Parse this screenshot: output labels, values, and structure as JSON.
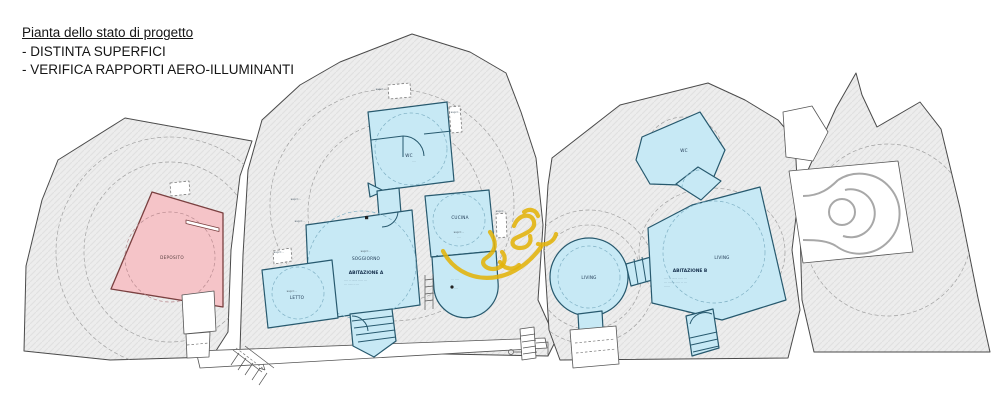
{
  "title": {
    "heading": "Pianta dello stato di progetto",
    "bullet1": "- DISTINTA SUPERFICI",
    "bullet2": "- VERIFICA RAPPORTI AERO-ILLUMINANTI"
  },
  "palette": {
    "unit_fill": "#c7e9f5",
    "unit_border": "#27596e",
    "deposito_fill": "#f5c4c8",
    "deposito_border": "#7a4040",
    "rock_fill": "#ededed",
    "rock_outline": "#4a4a4a",
    "marker_yellow": "#e3b30a"
  },
  "rooms": {
    "deposito": "DEPOSITO",
    "wc_a": "WC",
    "cucina": "CUCINA",
    "soggiorno": "SOGGIORNO",
    "abitazione_a": "ABITAZIONE A",
    "letto": "LETTO",
    "living_circle": "LIVING",
    "living_b": "LIVING",
    "abitazione_b": "ABITAZIONE B",
    "wc_b": "WC"
  },
  "annotations": {
    "items": [
      {
        "x": 381,
        "y": 90,
        "text": "sup=···"
      },
      {
        "x": 456,
        "y": 113,
        "text": "sup=···"
      },
      {
        "x": 296,
        "y": 200,
        "text": "sup=···"
      },
      {
        "x": 300,
        "y": 222,
        "text": "sup=···"
      },
      {
        "x": 279,
        "y": 253,
        "text": "sup=···"
      },
      {
        "x": 366,
        "y": 252,
        "text": "sup=···"
      },
      {
        "x": 292,
        "y": 292,
        "text": "sup=···"
      },
      {
        "x": 459,
        "y": 233,
        "text": "sup=···"
      },
      {
        "x": 459,
        "y": 238,
        "text": "····"
      },
      {
        "x": 501,
        "y": 212,
        "text": "sup=···"
      },
      {
        "x": 414,
        "y": 162,
        "text": "····"
      },
      {
        "x": 455,
        "y": 280,
        "text": "··· ····"
      },
      {
        "x": 456,
        "y": 289,
        "text": "····"
      },
      {
        "x": 344,
        "y": 281,
        "text": "···· ·· ······ ····· ···",
        "anchor": "start"
      },
      {
        "x": 344,
        "y": 285,
        "text": "··· ····· ·· ···",
        "anchor": "start"
      },
      {
        "x": 664,
        "y": 279,
        "text": "···· ·· ······ ····· ···",
        "anchor": "start"
      },
      {
        "x": 664,
        "y": 283,
        "text": "··· ········ ···· ·· ···",
        "anchor": "start"
      },
      {
        "x": 664,
        "y": 287,
        "text": "······",
        "anchor": "start"
      }
    ]
  }
}
